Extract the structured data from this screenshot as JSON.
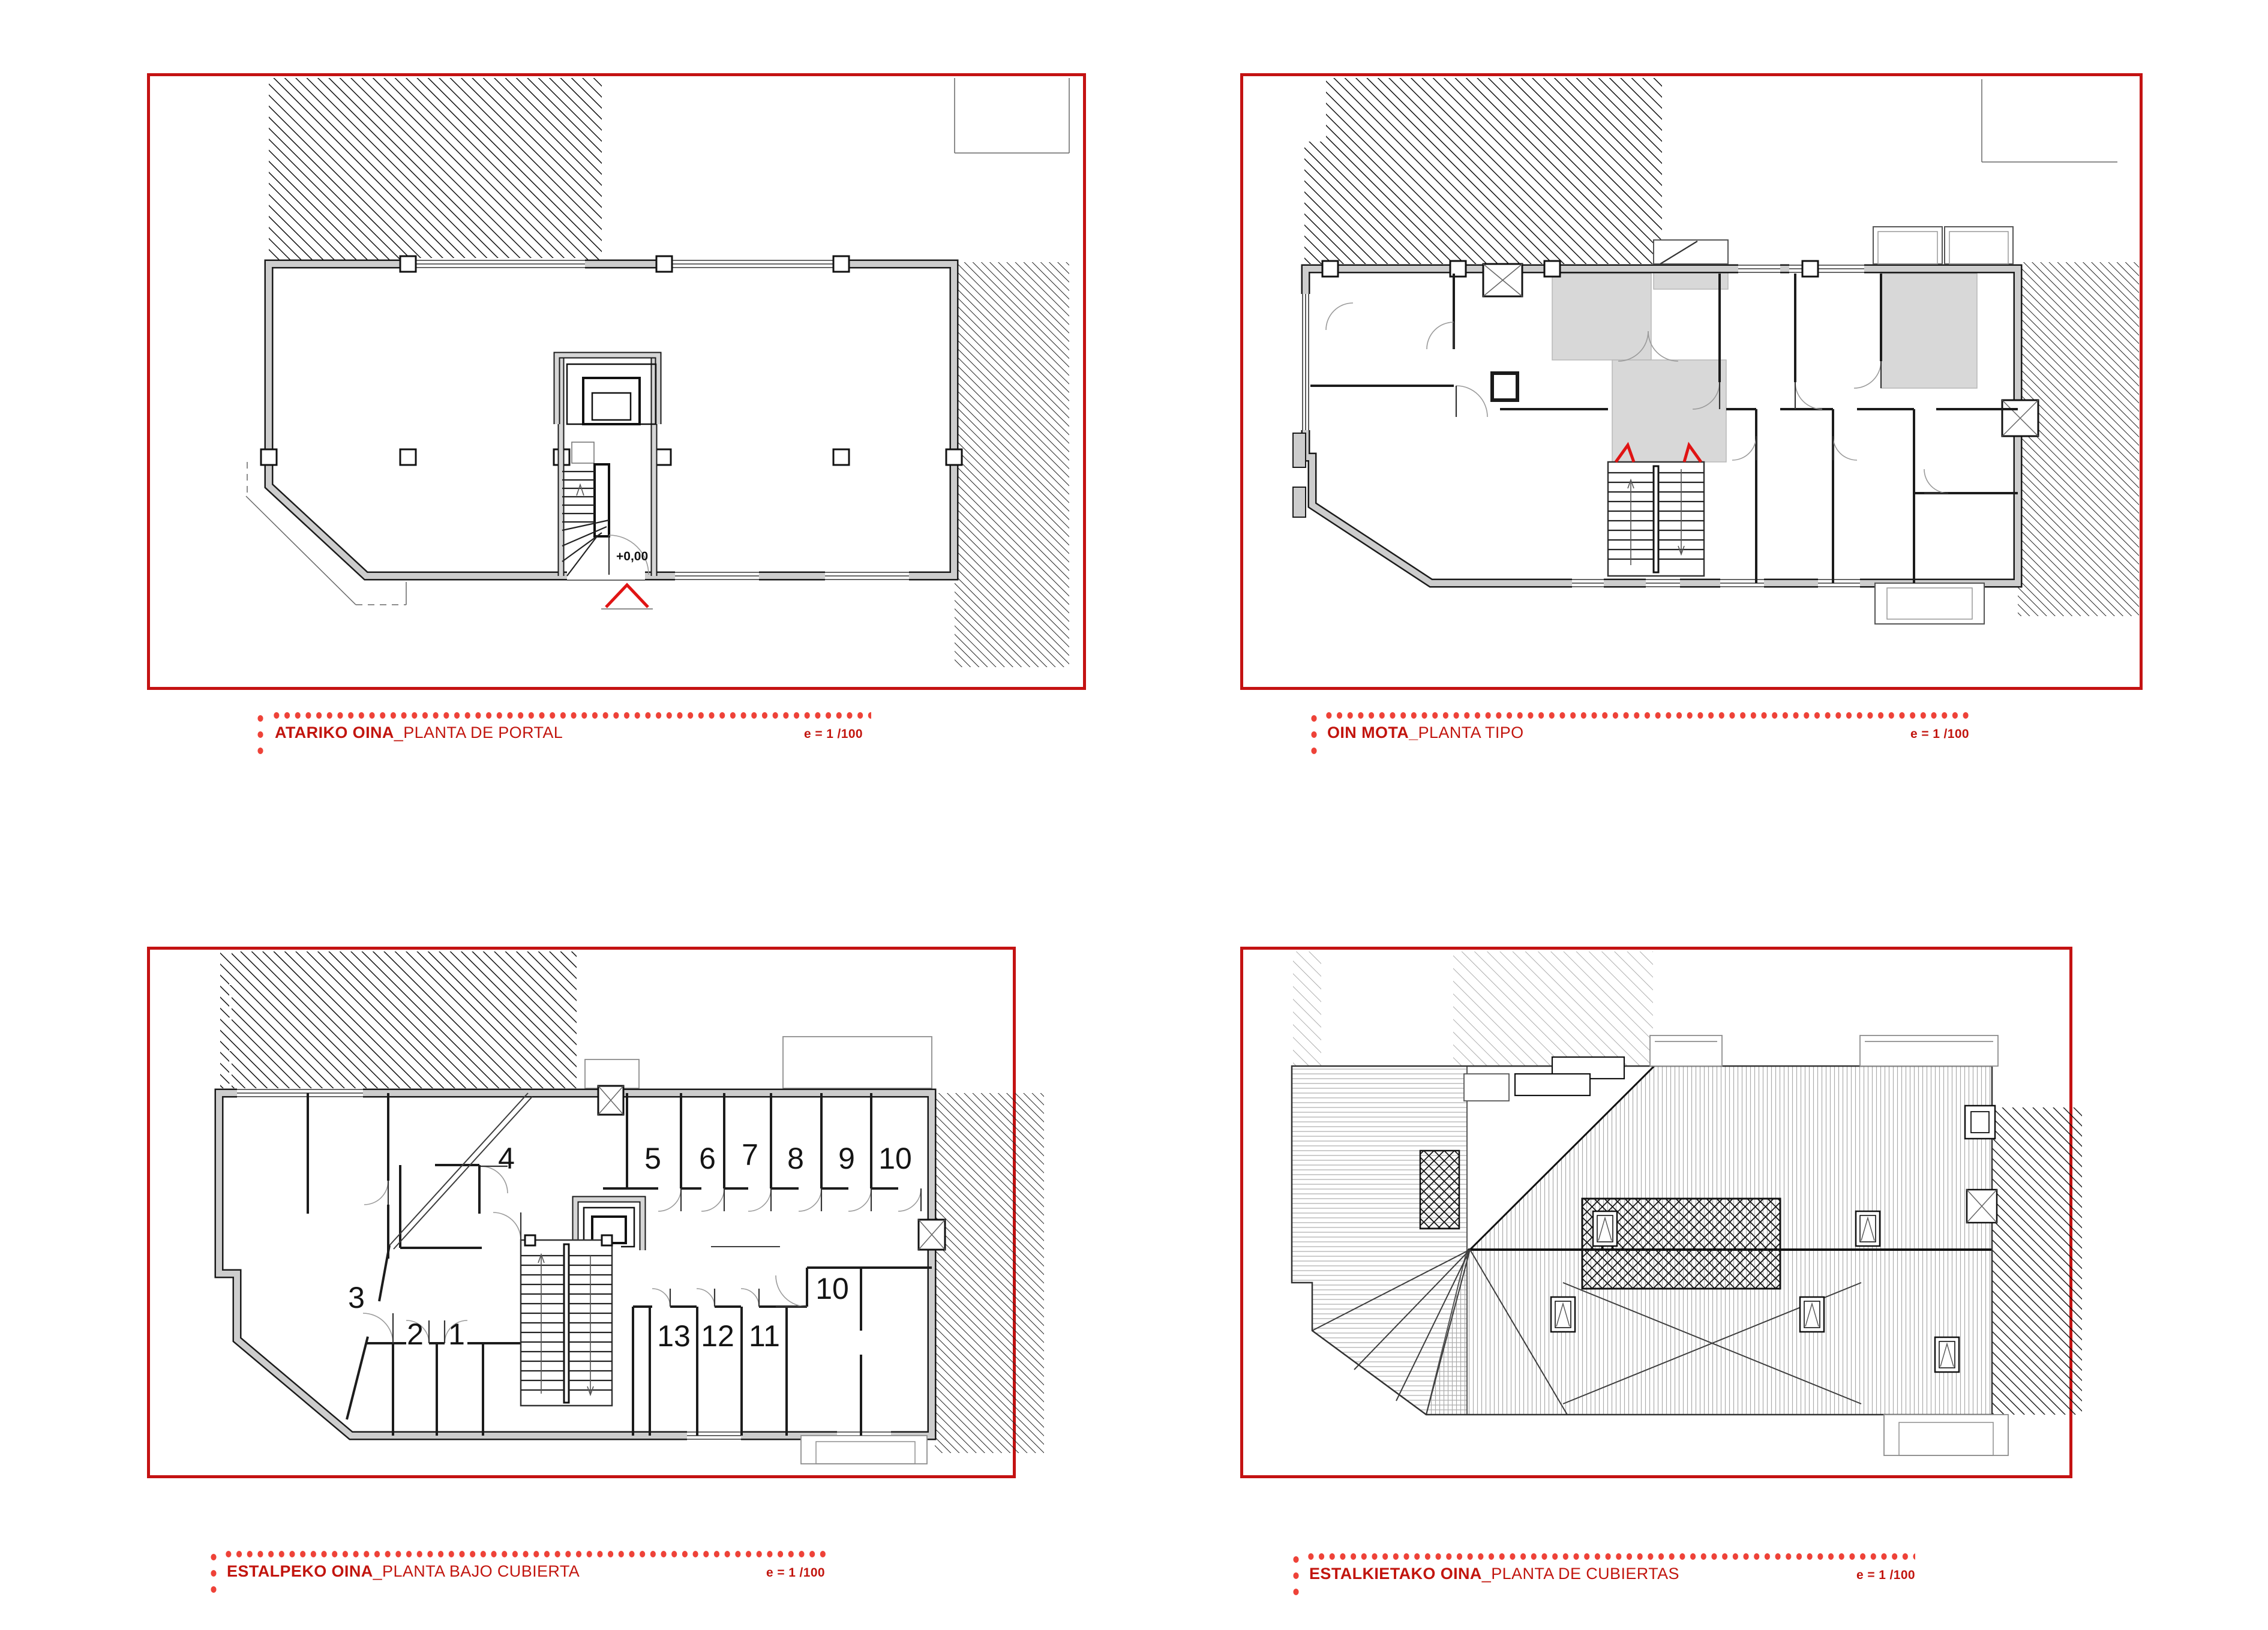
{
  "sheet": {
    "type": "architectural-floor-plans",
    "scale_note": "e = 1 /100"
  },
  "colors": {
    "frame_red": "#c41212",
    "dot_red": "#ee4238",
    "label_red": "#c2150e",
    "marker_red": "#e01414",
    "wall_gray": "#cdcdcd",
    "corridor_gray": "#d8d8d8",
    "line_black": "#1a1a1a"
  },
  "panels": [
    {
      "id": "atariko-oina",
      "name": "ATARIKO OINA",
      "subtitle": "_PLANTA DE PORTAL",
      "scale_label": "e = 1 /100",
      "level_label": "+0,00"
    },
    {
      "id": "oin-mota",
      "name": "OIN MOTA_",
      "subtitle": " PLANTA TIPO",
      "scale_label": "e = 1 /100"
    },
    {
      "id": "estalpeko-oina",
      "name": "ESTALPEKO OINA",
      "subtitle": "_PLANTA BAJO CUBIERTA",
      "scale_label": "e = 1 /100",
      "rooms": [
        "4",
        "5",
        "6",
        "7",
        "8",
        "9",
        "10",
        "10",
        "13",
        "12",
        "11",
        "1",
        "2",
        "3"
      ]
    },
    {
      "id": "estalkietako-oina",
      "name": "ESTALKIETAKO OINA",
      "subtitle": "_PLANTA DE CUBIERTAS",
      "scale_label": "e = 1 /100"
    }
  ]
}
